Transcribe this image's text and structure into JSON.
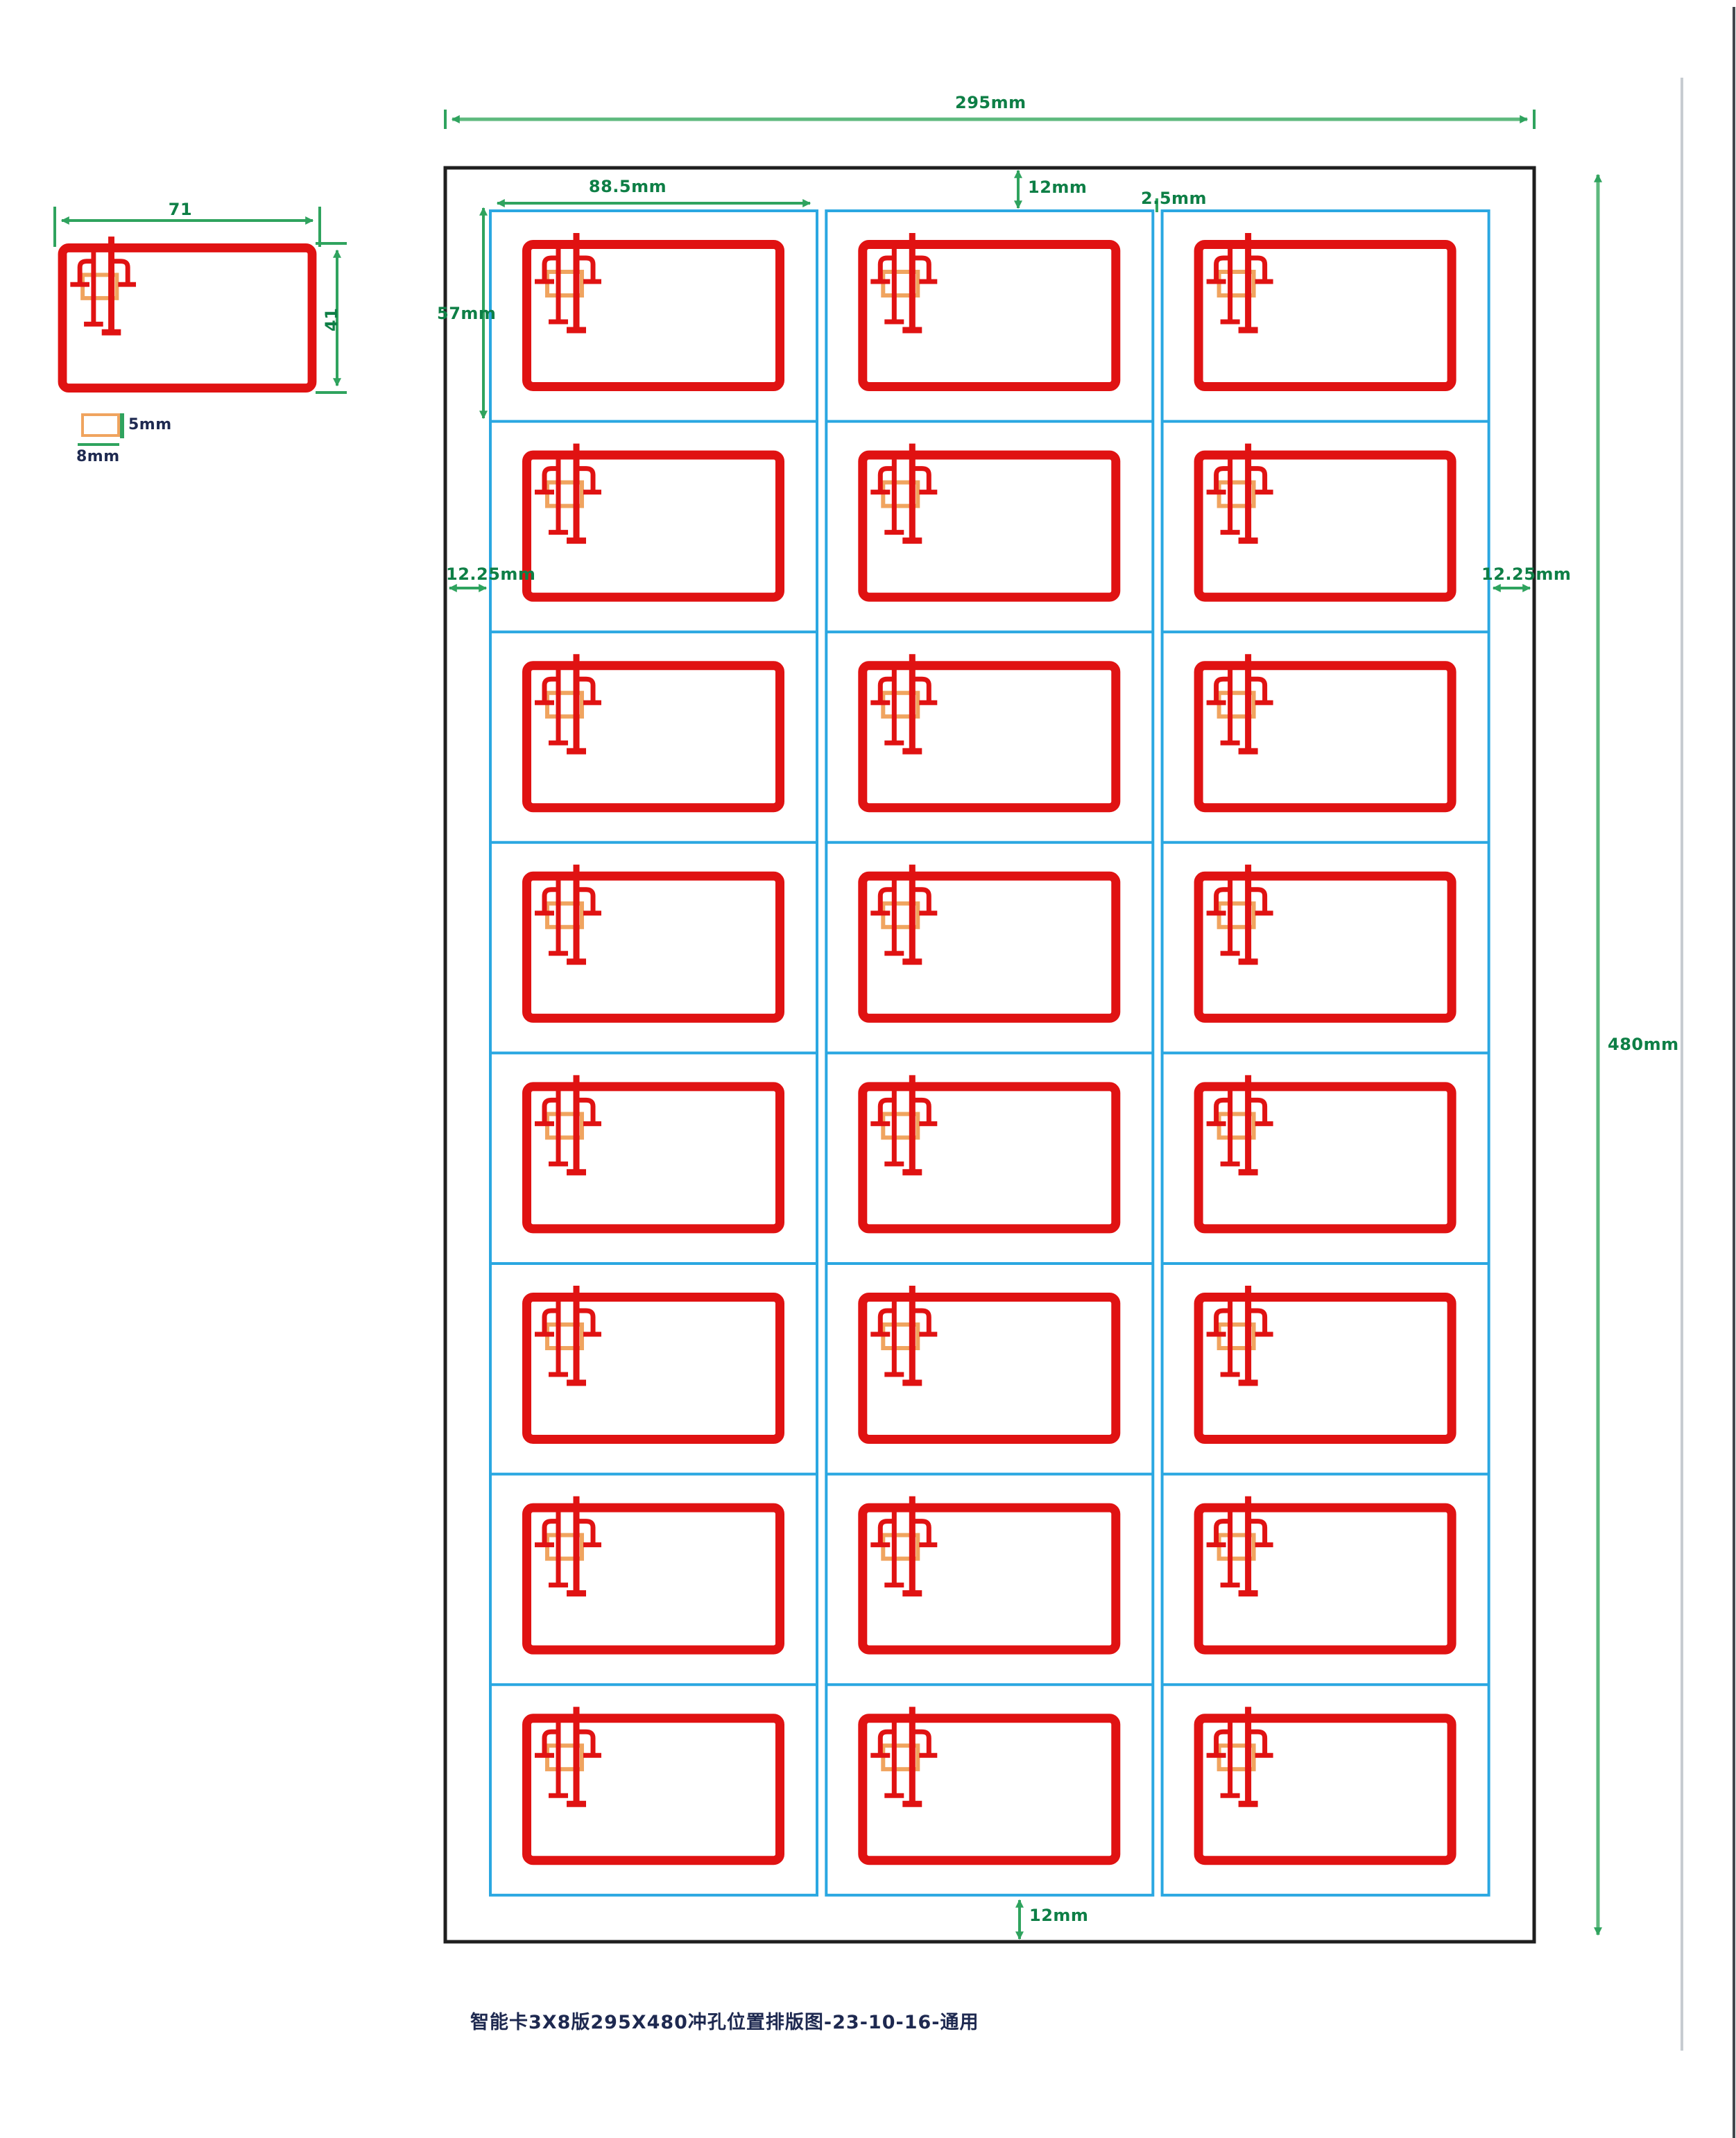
{
  "title_block": {
    "text": "智能卡3X8版295X480冲孔位置排版图-23-10-16-通用"
  },
  "dimensions": {
    "sheet_width": "295mm",
    "sheet_height": "480mm",
    "cell_width": "88.5mm",
    "cell_height": "57mm",
    "top_margin": "12mm",
    "bottom_margin": "12mm",
    "left_margin": "12.25mm",
    "right_margin": "12.25mm",
    "column_gap": "2.5mm"
  },
  "detail_card": {
    "width_label": "71",
    "height_label": "41"
  },
  "chip_legend": {
    "height_label": "5mm",
    "width_label": "8mm"
  },
  "grid": {
    "columns": 3,
    "rows": 8,
    "card_count": 24
  },
  "colors": {
    "card_red": "#e01212",
    "grid_blue": "#2aa7e1",
    "dimension_green": "#2fa35e",
    "dimension_light": "#5eb97e",
    "label_green": "#0e7f46",
    "chip_orange": "#f0a45f",
    "frame_black": "#1f1f1f",
    "text_navy": "#1e2950",
    "page_edge_gray": "#c7ccd1",
    "window_edge_dark": "#42474d"
  }
}
